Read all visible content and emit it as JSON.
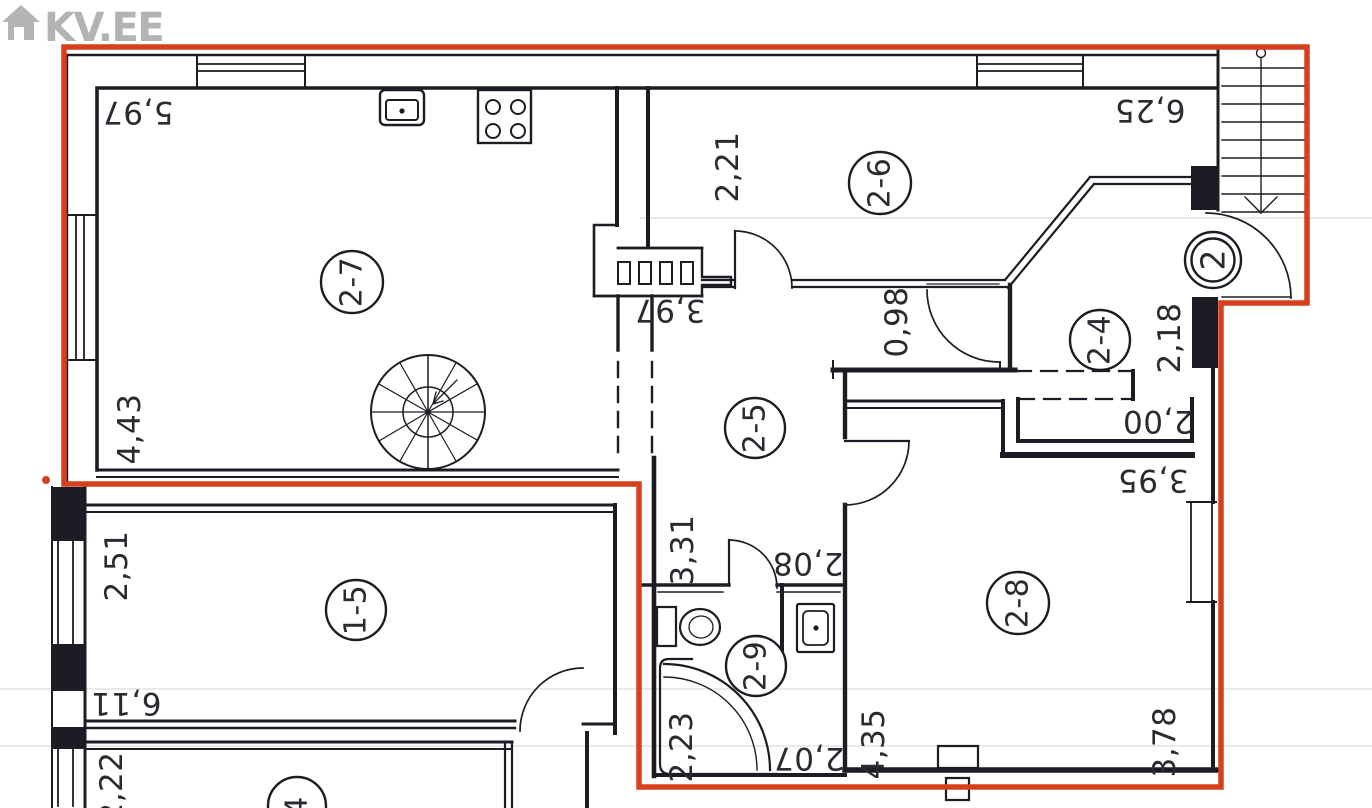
{
  "logo": {
    "text": "KV.EE"
  },
  "colors": {
    "boundary": "#d7401f",
    "wall": "#1c1c24",
    "label": "#2a2a31",
    "logo": "#b3b3b3"
  },
  "floorplan": {
    "entrance": {
      "label": "2",
      "cx": 1213,
      "cy": 260,
      "r_outer": 28,
      "r_inner": 21.5
    },
    "rooms": [
      {
        "id": "2-7",
        "cx": 352,
        "cy": 282,
        "r": 31
      },
      {
        "id": "2-6",
        "cx": 880,
        "cy": 183,
        "r": 31
      },
      {
        "id": "2-5",
        "cx": 755,
        "cy": 428,
        "r": 30
      },
      {
        "id": "2-4",
        "cx": 1100,
        "cy": 340,
        "r": 30
      },
      {
        "id": "2-8",
        "cx": 1018,
        "cy": 603,
        "r": 31
      },
      {
        "id": "2-9",
        "cx": 756,
        "cy": 666,
        "r": 30
      },
      {
        "id": "1-5",
        "cx": 356,
        "cy": 610,
        "r": 30
      },
      {
        "id": "4",
        "cx": 297,
        "cy": 806,
        "r": 29
      }
    ],
    "dimensions": [
      {
        "value": "5,97",
        "x": 138,
        "y": 112,
        "rot": 180
      },
      {
        "value": "2,21",
        "x": 728,
        "y": 167,
        "rot": -90
      },
      {
        "value": "6,25",
        "x": 1150,
        "y": 110,
        "rot": 180
      },
      {
        "value": "4,43",
        "x": 130,
        "y": 429,
        "rot": -90
      },
      {
        "value": "3,97",
        "x": 670,
        "y": 310,
        "rot": 180
      },
      {
        "value": "0,98",
        "x": 897,
        "y": 322,
        "rot": -90
      },
      {
        "value": "2,18",
        "x": 1170,
        "y": 338,
        "rot": -90
      },
      {
        "value": "2,00",
        "x": 1158,
        "y": 421,
        "rot": 180
      },
      {
        "value": "3,95",
        "x": 1153,
        "y": 480,
        "rot": 180
      },
      {
        "value": "3,31",
        "x": 683,
        "y": 550,
        "rot": -90
      },
      {
        "value": "2,08",
        "x": 808,
        "y": 563,
        "rot": 180
      },
      {
        "value": "2,51",
        "x": 117,
        "y": 566,
        "rot": -90
      },
      {
        "value": "6,11",
        "x": 126,
        "y": 703,
        "rot": 180
      },
      {
        "value": "2,22",
        "x": 112,
        "y": 787,
        "rot": -90
      },
      {
        "value": "2,23",
        "x": 682,
        "y": 747,
        "rot": -90
      },
      {
        "value": "2,07",
        "x": 809,
        "y": 758,
        "rot": 180
      },
      {
        "value": "4,35",
        "x": 874,
        "y": 744,
        "rot": -90
      },
      {
        "value": "3,78",
        "x": 1165,
        "y": 742,
        "rot": -90
      }
    ]
  }
}
